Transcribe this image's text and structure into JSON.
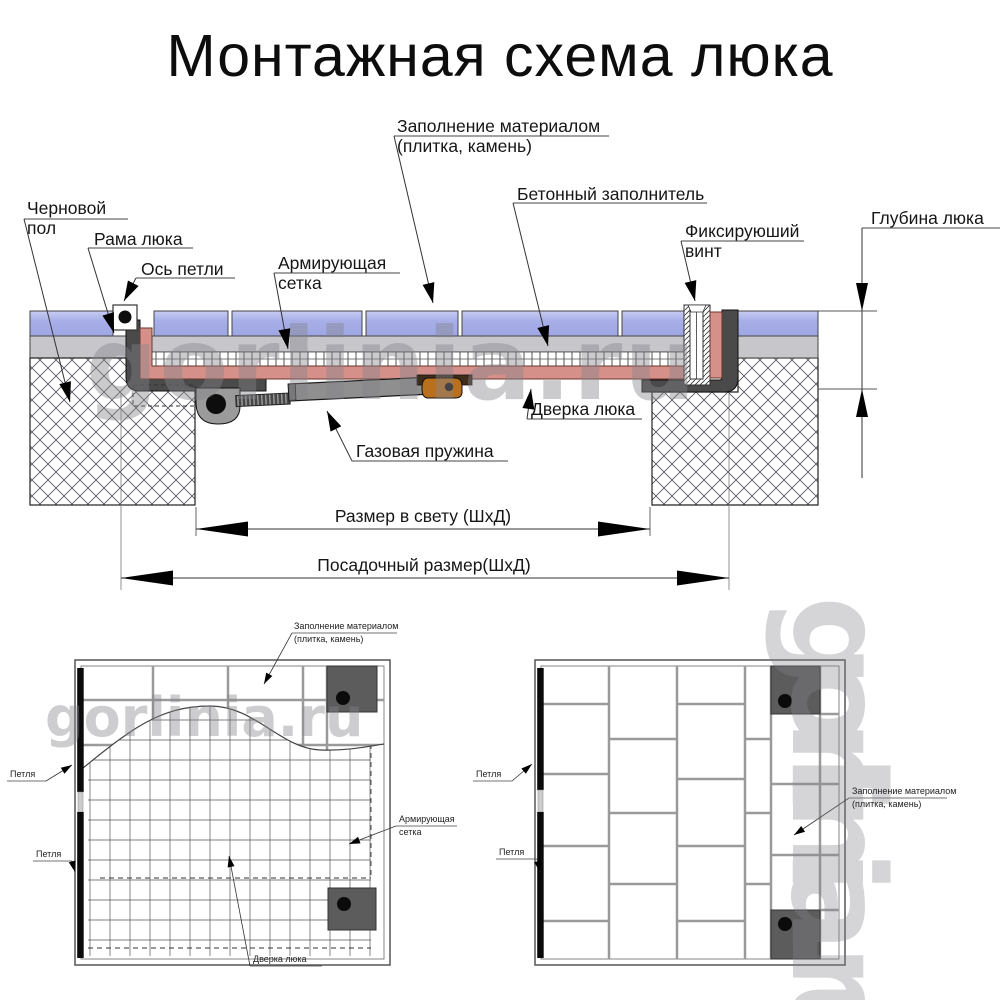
{
  "title": "Монтажная схема люка",
  "watermark": "gorlinia.ru",
  "section": {
    "fill_line1": "Заполнение материалом",
    "fill_line2": "(плитка, камень)",
    "concrete": "Бетонный заполнитель",
    "rough_line1": "Черновой",
    "rough_line2": "пол",
    "frame": "Рама люка",
    "axis": "Ось петли",
    "mesh_line1": "Армирующая",
    "mesh_line2": "сетка",
    "screw_line1": "Фиксируюший",
    "screw_line2": "винт",
    "depth": "Глубина люка",
    "door": "Дверка люка",
    "spring": "Газовая пружина",
    "clear_size": "Размер в свету (ШхД)",
    "mount_size": "Посадочный размер(ШхД)"
  },
  "plan_left": {
    "fill_line1": "Заполнение материалом",
    "fill_line2": "(плитка, камень)",
    "hinge_top": "Петля",
    "hinge_bottom": "Петля",
    "mesh_line1": "Армирующая",
    "mesh_line2": "сетка",
    "door": "Дверка люка"
  },
  "plan_right": {
    "hinge_top": "Петля",
    "hinge_bottom": "Петля",
    "fill_line1": "Заполнение материалом",
    "fill_line2": "(плитка, камень)"
  },
  "colors": {
    "tile_blue": "#a7aee8",
    "concrete_gray": "#c6c6cb",
    "door_pan_pink": "#d5908a",
    "frame_dark": "#4a4a4a",
    "bracket_orange": "#b9701c",
    "lock_square_gray": "#5c5c5c",
    "watermark_gray": "#85858b"
  }
}
